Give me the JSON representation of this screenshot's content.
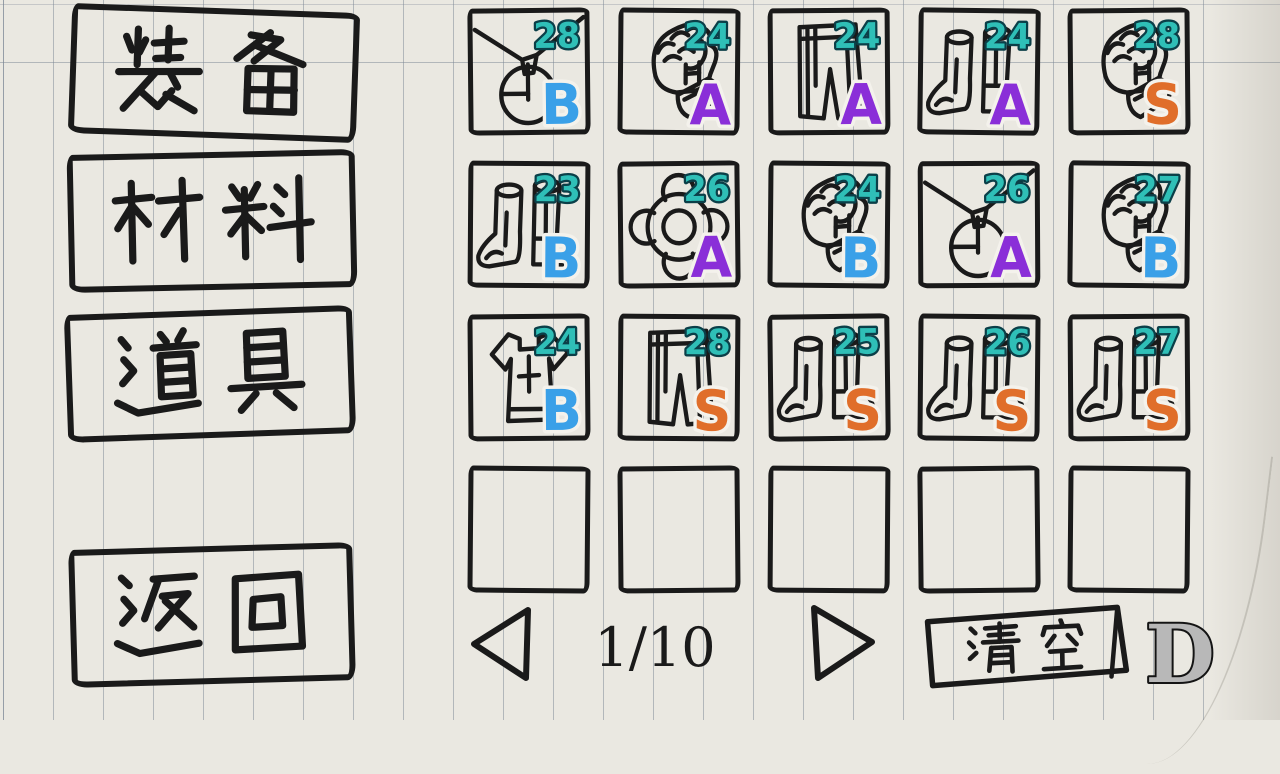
{
  "colors": {
    "paper": "#eae8e1",
    "ink": "#1a1a1a",
    "guide_line": "#7a8594",
    "level": "#2fbfb7",
    "level_outline": "#0b3f48",
    "grade_B": "#3aa0e8",
    "grade_A": "#8a2fd8",
    "grade_S": "#e06e2a",
    "d_fill": "#b8b8b8"
  },
  "menu": {
    "items": [
      {
        "id": "equipment",
        "label": "装备"
      },
      {
        "id": "materials",
        "label": "材料"
      },
      {
        "id": "items",
        "label": "道具"
      },
      {
        "id": "back",
        "label": "返回"
      }
    ]
  },
  "inventory": {
    "rows": 4,
    "cols": 5,
    "slots": [
      {
        "icon": "necklace",
        "level": "28",
        "grade": "B"
      },
      {
        "icon": "fist",
        "level": "24",
        "grade": "A"
      },
      {
        "icon": "pants",
        "level": "24",
        "grade": "A"
      },
      {
        "icon": "boots",
        "level": "24",
        "grade": "A"
      },
      {
        "icon": "fist",
        "level": "28",
        "grade": "S"
      },
      {
        "icon": "boots",
        "level": "23",
        "grade": "B"
      },
      {
        "icon": "ring",
        "level": "26",
        "grade": "A"
      },
      {
        "icon": "fist",
        "level": "24",
        "grade": "B"
      },
      {
        "icon": "necklace",
        "level": "26",
        "grade": "A"
      },
      {
        "icon": "fist",
        "level": "27",
        "grade": "B"
      },
      {
        "icon": "shirt",
        "level": "24",
        "grade": "B"
      },
      {
        "icon": "pants",
        "level": "28",
        "grade": "S"
      },
      {
        "icon": "boots",
        "level": "25",
        "grade": "S"
      },
      {
        "icon": "boots",
        "level": "26",
        "grade": "S"
      },
      {
        "icon": "boots",
        "level": "27",
        "grade": "S"
      },
      {
        "icon": null,
        "level": null,
        "grade": null
      },
      {
        "icon": null,
        "level": null,
        "grade": null
      },
      {
        "icon": null,
        "level": null,
        "grade": null
      },
      {
        "icon": null,
        "level": null,
        "grade": null
      },
      {
        "icon": null,
        "level": null,
        "grade": null
      }
    ]
  },
  "pagination": {
    "current": "1/10",
    "prev_icon": "left-triangle",
    "next_icon": "right-triangle"
  },
  "clear_button": {
    "label": "清空"
  },
  "watermark": {
    "label": "D"
  }
}
